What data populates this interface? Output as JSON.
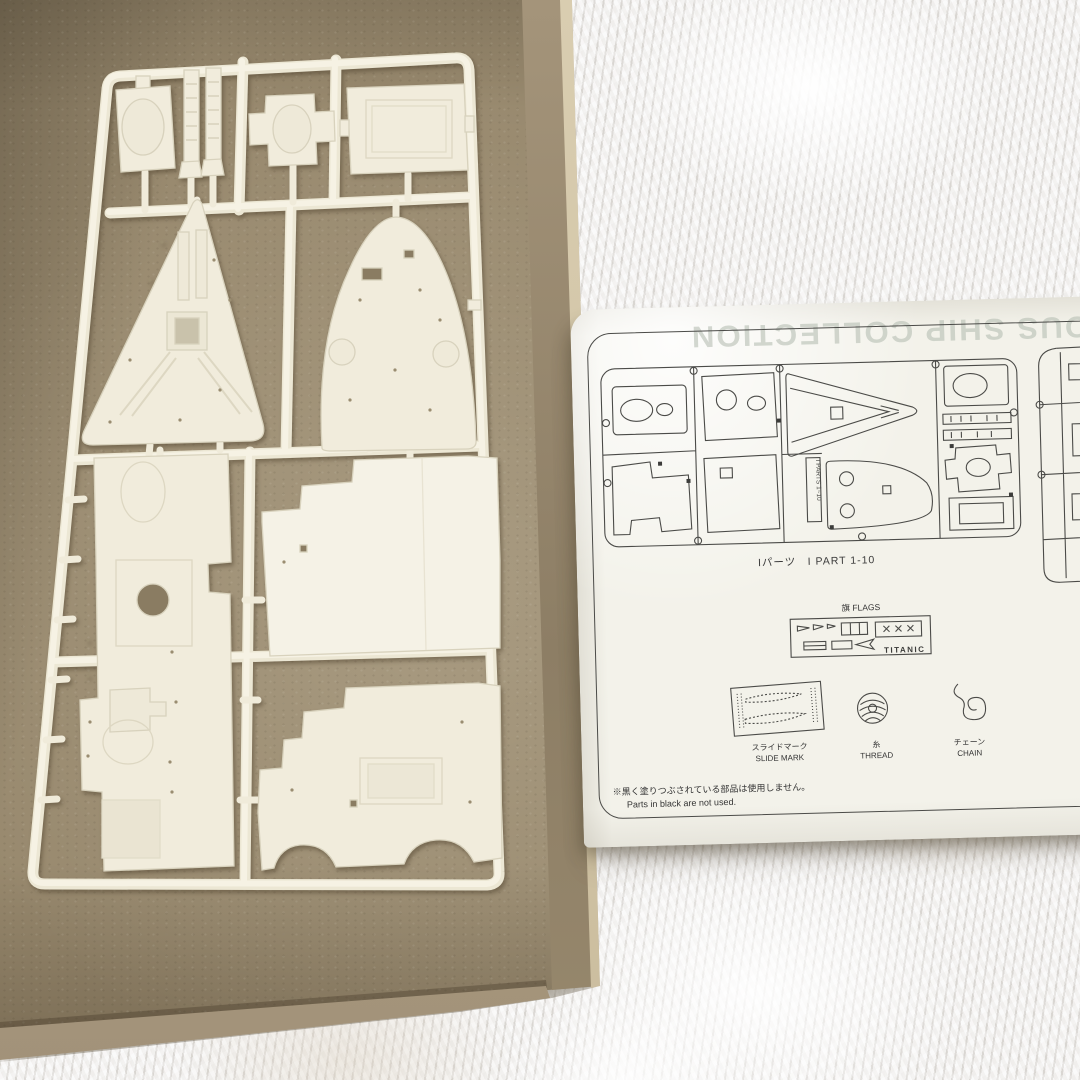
{
  "sheet": {
    "show_through_title": "THE FAMOUS SHIP COLLECTION",
    "diagram1": {
      "caption": "Iパーツ　I PART 1-10",
      "label_strip": "I PARTS 1~10"
    },
    "flags_section": {
      "label": "旗 FLAGS",
      "ship_name": "TITANIC"
    },
    "accessories": [
      {
        "icon": "slide-mark-decal-icon",
        "label_jp": "スライドマーク",
        "label_en": "SLIDE MARK"
      },
      {
        "icon": "thread-spool-icon",
        "label_jp": "糸",
        "label_en": "THREAD"
      },
      {
        "icon": "chain-icon",
        "label_jp": "チェーン",
        "label_en": "CHAIN"
      }
    ],
    "note": {
      "jp": "※黒く塗りつぶされている部品は使用しません。",
      "en": "Parts in black are not used."
    }
  },
  "colors": {
    "cardboard_floor": "#98896e",
    "cardboard_wall": "#a4947a",
    "sprue_plastic": "#f3efe1",
    "paper": "#f3f2ea",
    "ink": "#4b4b48",
    "fur": "#e9e7e5",
    "show_through_text": "#b7bfb4"
  }
}
